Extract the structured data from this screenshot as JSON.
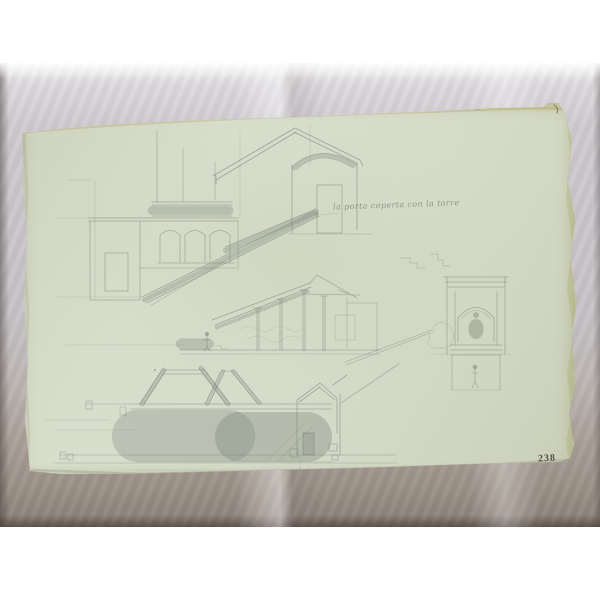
{
  "scene": {
    "description": "Photograph of an antique architectural pencil sketch (building sections, staircase, loggia, portico, niche aedicula, trellis) on aged green-tinted paper lying on crumpled grey tissue",
    "inscription": "la porta coperta con la torre",
    "page_number": "238"
  },
  "colors": {
    "canvas": "#ffffff",
    "fabric": "#c6c2c7",
    "fabric_shadow": "#8a7f76",
    "paper": "#d6dcca",
    "edge_stain": "#a89448",
    "pencil": "#67716a",
    "number_ink": "#3e3a2c"
  }
}
